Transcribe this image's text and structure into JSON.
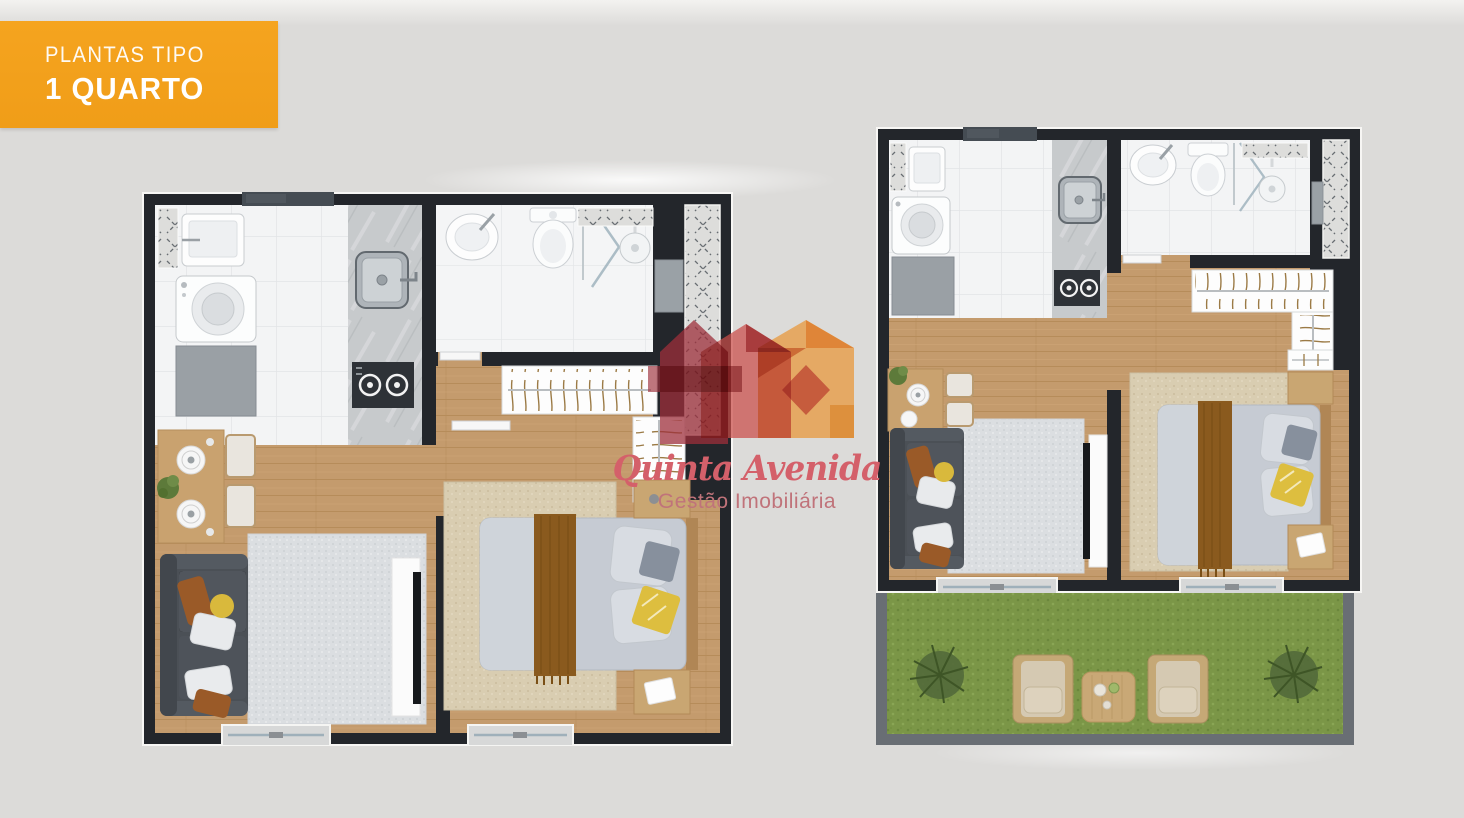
{
  "badge": {
    "title": "PLANTAS TIPO",
    "subtitle": "1 QUARTO"
  },
  "logo": {
    "title": "Quinta Avenida",
    "subtitle": "Gestão Imobiliária"
  },
  "plans": {
    "count": 2,
    "left_variant": "1 quarto",
    "right_variant": "1 quarto com garden"
  },
  "colors": {
    "bg": "#dcdbd9",
    "badgeBg": "#f5a41f",
    "badgeText": "#ffffff",
    "wall": "#23262b",
    "slate": "#454c53",
    "floorTile": "#f3f4f5",
    "marble": "#c7cacc",
    "wood": "#c49b6d",
    "rugGray": "#dbdee1",
    "rugBeige": "#d9cdb1",
    "sofa": "#4b5056",
    "bed": "#c6cbd3",
    "throwBrown": "#8a5a1e",
    "pillowYellow": "#ddbe3f",
    "grass": "#7b9647",
    "gardenWall": "#696e74",
    "cabinetGray": "#9aa0a5",
    "logoDarkRed": "#9d2f3a",
    "logoRed": "#cb4d49",
    "logoOrange": "#e8993d",
    "logoTitle": "#d4606a",
    "logoSubtitle": "#c0737a"
  }
}
